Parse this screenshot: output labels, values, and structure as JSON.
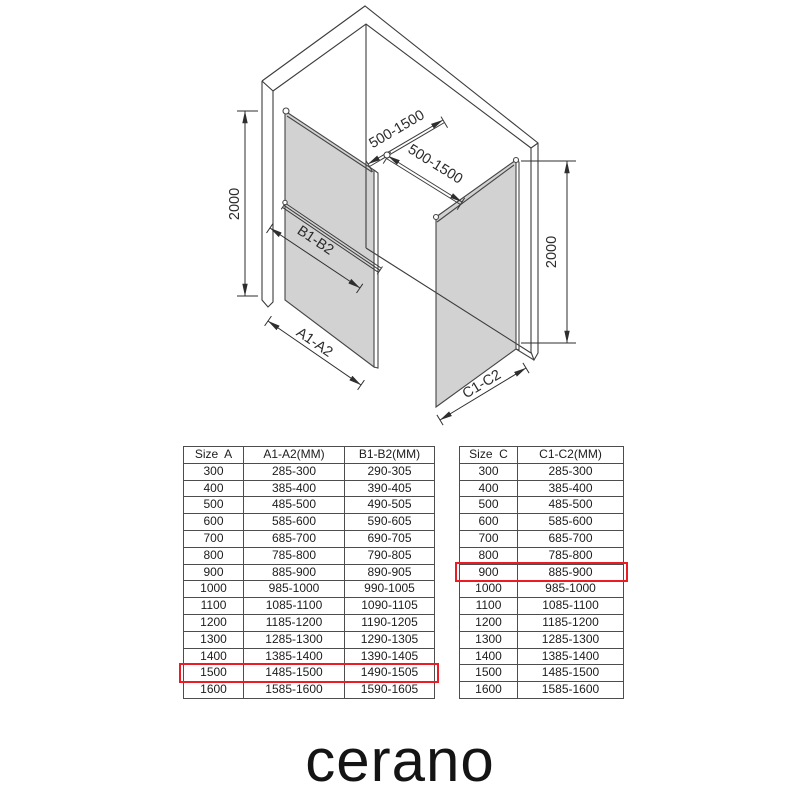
{
  "diagram": {
    "labels": {
      "height_left": "2000",
      "height_right": "2000",
      "support_bar_left": "500-1500",
      "support_bar_right": "500-1500",
      "panel_a_width": "A1-A2",
      "panel_a_bar": "B1-B2",
      "panel_c_width": "C1-C2"
    },
    "colors": {
      "glass_gray": "#d2d2d2",
      "line": "#3c3c3c",
      "highlight_red": "#ec1c24"
    }
  },
  "tables": {
    "left": {
      "headers": [
        "Size  A",
        "A1-A2(MM)",
        "B1-B2(MM)"
      ],
      "rows": [
        [
          "300",
          "285-300",
          "290-305"
        ],
        [
          "400",
          "385-400",
          "390-405"
        ],
        [
          "500",
          "485-500",
          "490-505"
        ],
        [
          "600",
          "585-600",
          "590-605"
        ],
        [
          "700",
          "685-700",
          "690-705"
        ],
        [
          "800",
          "785-800",
          "790-805"
        ],
        [
          "900",
          "885-900",
          "890-905"
        ],
        [
          "1000",
          "985-1000",
          "990-1005"
        ],
        [
          "1100",
          "1085-1100",
          "1090-1105"
        ],
        [
          "1200",
          "1185-1200",
          "1190-1205"
        ],
        [
          "1300",
          "1285-1300",
          "1290-1305"
        ],
        [
          "1400",
          "1385-1400",
          "1390-1405"
        ],
        [
          "1500",
          "1485-1500",
          "1490-1505"
        ],
        [
          "1600",
          "1585-1600",
          "1590-1605"
        ]
      ],
      "highlighted_value": "1500",
      "highlighted_row_index": 12
    },
    "right": {
      "headers": [
        "Size  C",
        "C1-C2(MM)"
      ],
      "rows": [
        [
          "300",
          "285-300"
        ],
        [
          "400",
          "385-400"
        ],
        [
          "500",
          "485-500"
        ],
        [
          "600",
          "585-600"
        ],
        [
          "700",
          "685-700"
        ],
        [
          "800",
          "785-800"
        ],
        [
          "900",
          "885-900"
        ],
        [
          "1000",
          "985-1000"
        ],
        [
          "1100",
          "1085-1100"
        ],
        [
          "1200",
          "1185-1200"
        ],
        [
          "1300",
          "1285-1300"
        ],
        [
          "1400",
          "1385-1400"
        ],
        [
          "1500",
          "1485-1500"
        ],
        [
          "1600",
          "1585-1600"
        ]
      ],
      "highlighted_value": "900",
      "highlighted_row_index": 6
    }
  },
  "brand": {
    "logo_text": "cerano"
  }
}
